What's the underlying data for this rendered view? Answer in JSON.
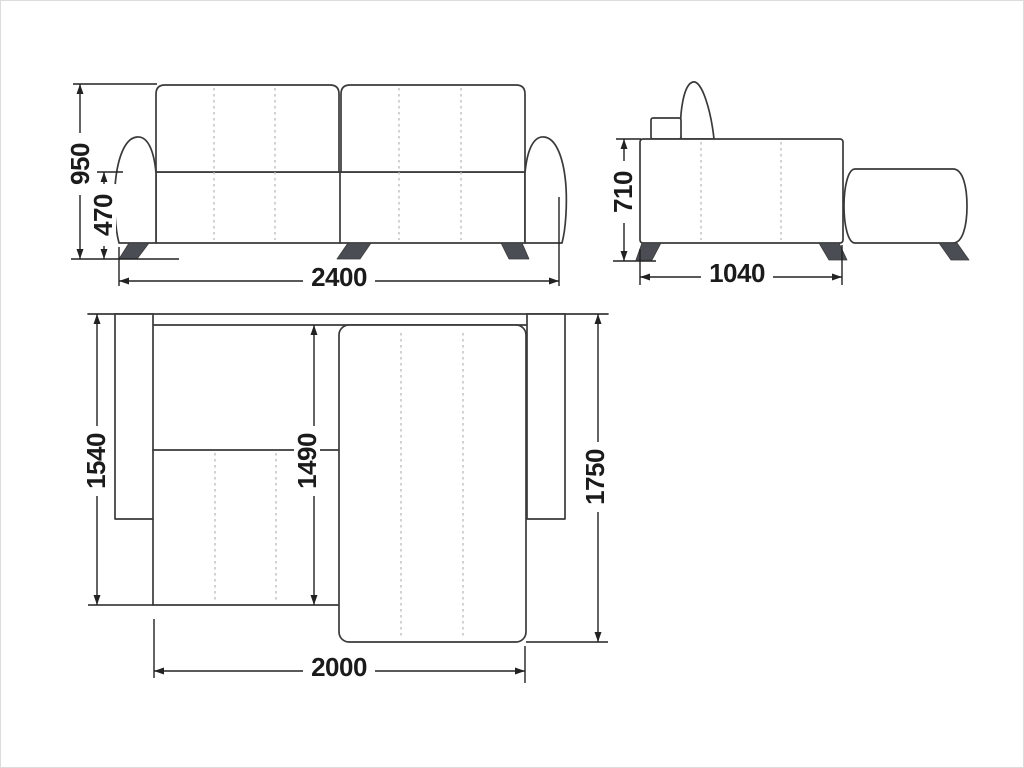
{
  "diagram": {
    "description": "Corner sofa technical drawing with three views and millimeter dimensions",
    "front_view": {
      "overall_height": "950",
      "seat_height": "470",
      "overall_width": "2400"
    },
    "side_view": {
      "body_height": "710",
      "body_depth": "1040"
    },
    "plan_view": {
      "left_side_depth": "1540",
      "seat_depth": "1490",
      "chaise_depth": "1750",
      "bed_length": "2000"
    }
  },
  "colors": {
    "outline": "#3a3a3a",
    "dimension_line": "#222222",
    "stitch_dash": "#b9b9b9",
    "leg_fill": "#4a4e54",
    "label_text": "#1b1b1b",
    "background": "#ffffff"
  }
}
